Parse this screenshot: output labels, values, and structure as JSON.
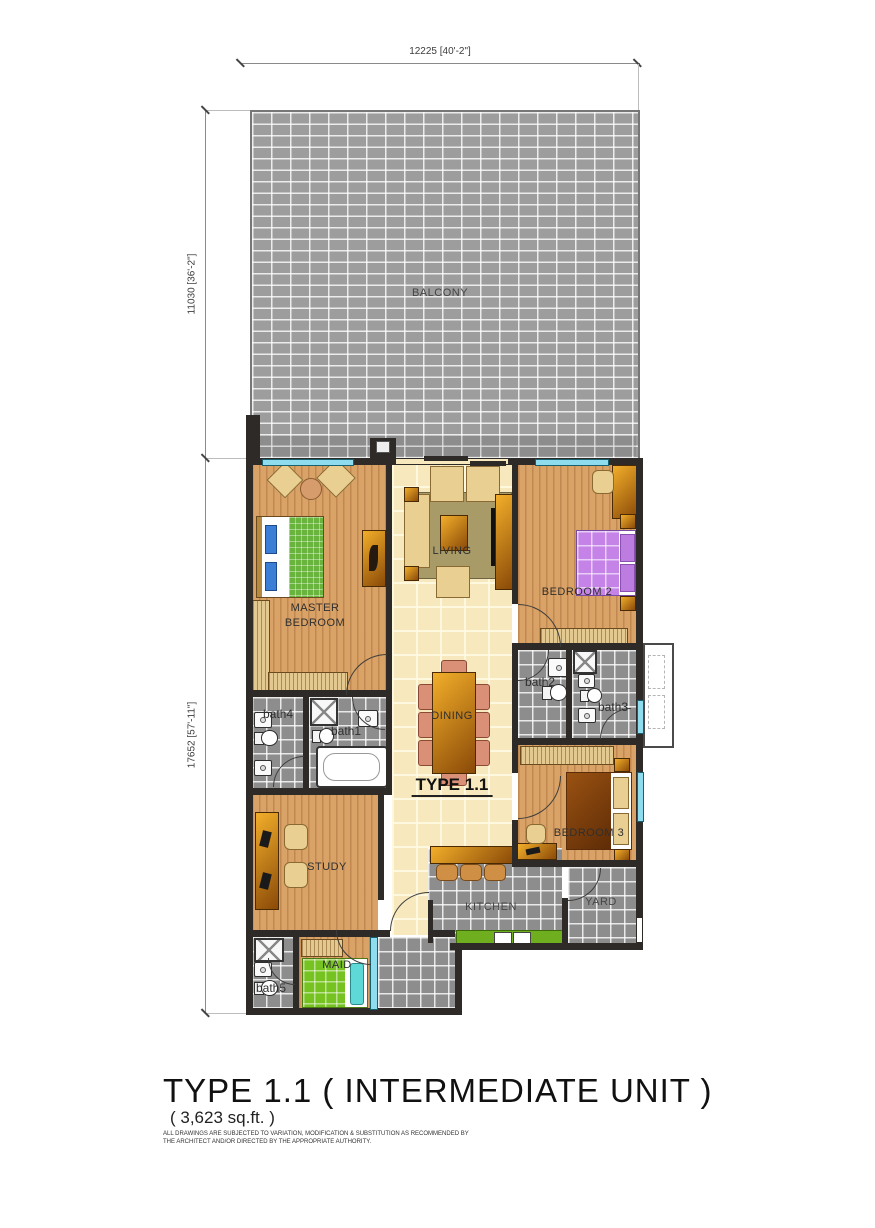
{
  "dims": {
    "top": "12225 [40'-2\"]",
    "left_upper": "11030 [36'-2\"]",
    "left_lower": "17652 [57'-11\"]"
  },
  "rooms": {
    "balcony": "BALCONY",
    "living": "LIVING",
    "dining": "DINING",
    "master_line1": "MASTER",
    "master_line2": "BEDROOM",
    "bedroom2": "BEDROOM 2",
    "bedroom3": "BEDROOM 3",
    "study": "STUDY",
    "kitchen": "KITCHEN",
    "yard": "YARD",
    "maid": "MAID",
    "bath1": "bath1",
    "bath2": "bath2",
    "bath3": "bath3",
    "bath4": "bath4",
    "bath5": "bath5"
  },
  "plan_label": "TYPE 1.1",
  "title_block": {
    "title": "TYPE 1.1 ( INTERMEDIATE UNIT )",
    "area": "( 3,623 sq.ft. )",
    "disclaimer_line1": "ALL DRAWINGS ARE SUBJECTED TO VARIATION, MODIFICATION & SUBSTITUTION AS RECOMMENDED BY",
    "disclaimer_line2": "THE ARCHITECT AND/OR DIRECTED BY THE APPROPRIATE AUTHORITY."
  },
  "palette": {
    "wall": "#2d2a27",
    "wood_floor": "#d9a266",
    "tile_cream": "#f7e9bd",
    "tile_gray": "#8d8d8d",
    "balcony_tile": "#9d9d9d",
    "window_glass": "#8fdcef",
    "kitchen_counter_green": "#6fae1e",
    "bed2_purple": "#c583e8",
    "maid_bed_green": "#76c221",
    "furniture_tan": "#e9cf92",
    "furniture_amber": "#cd7f1e",
    "dining_chair_salmon": "#d99077"
  }
}
